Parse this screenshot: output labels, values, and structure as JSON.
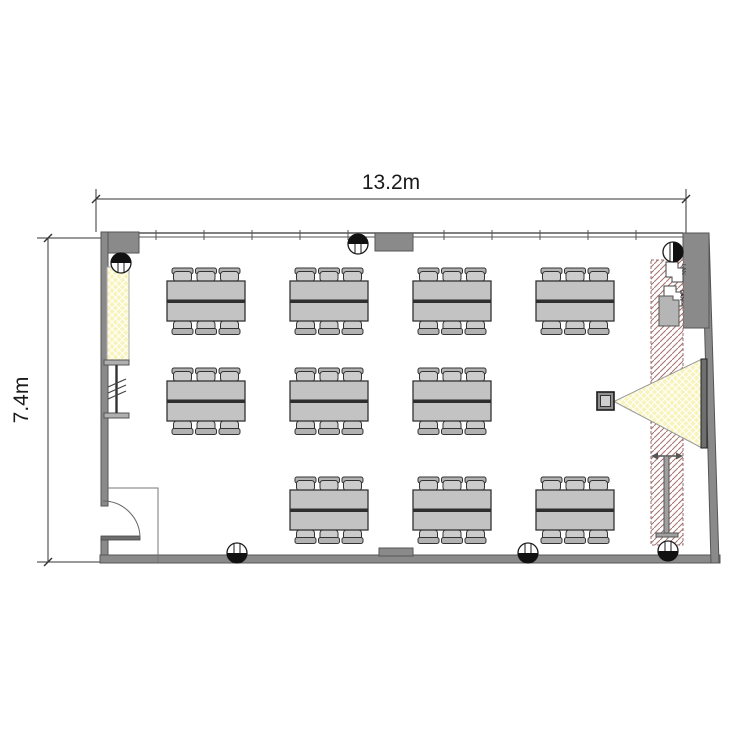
{
  "dimensions": {
    "width_label": "13.2m",
    "height_label": "7.4m"
  },
  "outlets": {
    "lan_top": "LAN",
    "lan_bottom": "LAN"
  },
  "colors": {
    "wall_gray": "#8a8a8a",
    "wall_outline": "#555555",
    "table_fill": "#c3c3c3",
    "chair_fill": "#cccccc",
    "chair_back": "#b2b2b2",
    "window_yellow": "#f8f3bb",
    "cone_yellow": "#f8f3bb",
    "hatch_red": "#a7716d",
    "screen_dark": "#6f6f6f"
  },
  "icons": {
    "ceiling_light": "half-filled-circle-with-lines",
    "projector": "square-in-square",
    "projection_cone": "hatched-yellow-triangle",
    "projection_screen": "dark-vertical-bar",
    "whiteboard_stand": "i-beam-with-arrows",
    "door": "quarter-circle-swing-arc",
    "window_light": "yellow-crosshatch-strip"
  },
  "floorplan": {
    "table_count": 10,
    "seats_per_table": 6,
    "tables": [
      {
        "x": 167,
        "y": 281
      },
      {
        "x": 290,
        "y": 281
      },
      {
        "x": 413,
        "y": 281
      },
      {
        "x": 536,
        "y": 281
      },
      {
        "x": 167,
        "y": 381
      },
      {
        "x": 290,
        "y": 381
      },
      {
        "x": 413,
        "y": 381
      },
      {
        "x": 290,
        "y": 490
      },
      {
        "x": 413,
        "y": 490
      },
      {
        "x": 536,
        "y": 490
      }
    ],
    "lights": [
      {
        "x": 121,
        "y": 263,
        "dir": "t"
      },
      {
        "x": 358,
        "y": 244,
        "dir": "t"
      },
      {
        "x": 673,
        "y": 252,
        "dir": "r"
      },
      {
        "x": 237,
        "y": 553,
        "dir": "b"
      },
      {
        "x": 528,
        "y": 553,
        "dir": "b"
      },
      {
        "x": 668,
        "y": 551,
        "dir": "b"
      }
    ]
  }
}
